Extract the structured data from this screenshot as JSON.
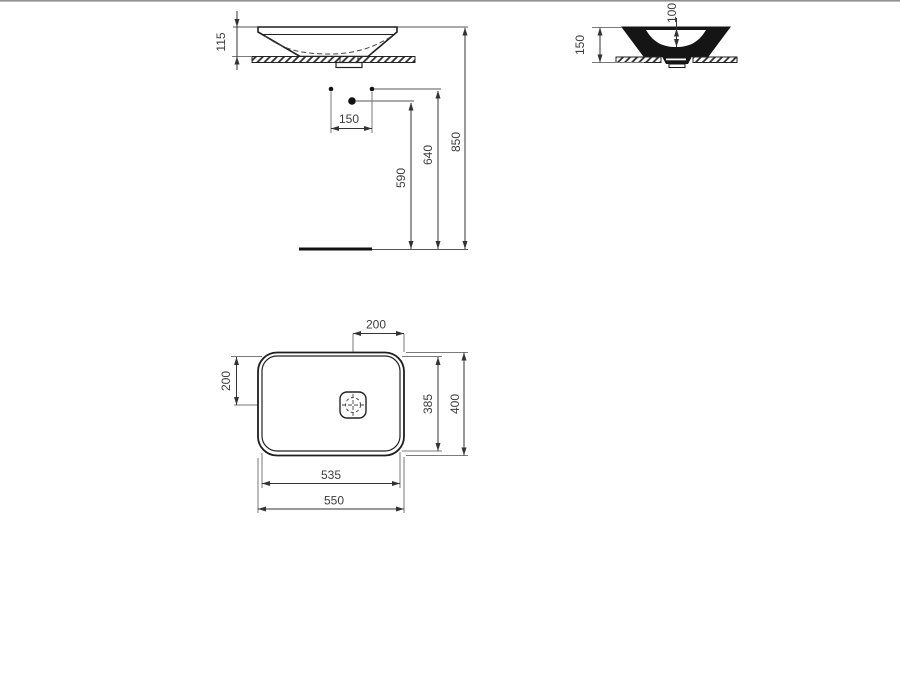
{
  "drawing": {
    "type": "technical-dimension-drawing",
    "subject": "countertop washbasin with three views",
    "front_view": {
      "rim_to_counter": "115",
      "tap_hole_spacing": "150",
      "drain_line_height": "590",
      "tap_line_height": "640",
      "rim_height": "850"
    },
    "side_view": {
      "bowl_inner_depth": "100",
      "overall_height": "150"
    },
    "plan_view": {
      "drain_center_from_right": "200",
      "drain_center_from_top": "200",
      "inner_depth": "385",
      "outer_depth": "400",
      "inner_width": "535",
      "outer_width": "550"
    }
  },
  "colors": {
    "background": "#ffffff",
    "outline": "#1f1f1f",
    "dimension_line": "#333333",
    "extension_line": "#7a7a7a",
    "text": "#3c3c3c",
    "top_border": "#909090"
  }
}
